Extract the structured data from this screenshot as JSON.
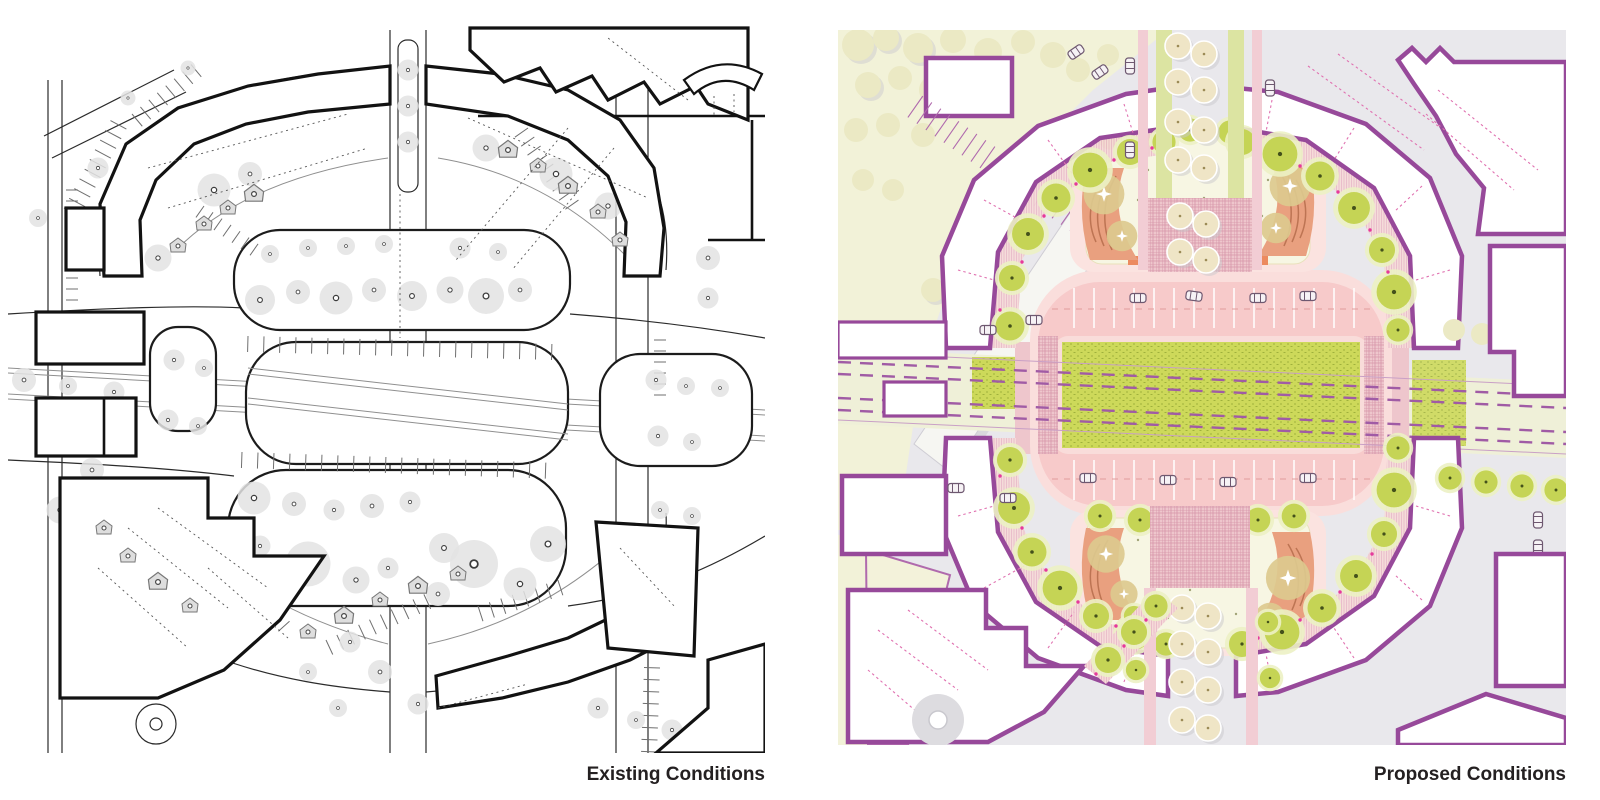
{
  "page": {
    "type": "architectural site plan comparison",
    "background": "#ffffff"
  },
  "panels": [
    {
      "id": "existing",
      "label": "Existing Conditions",
      "style": "monochrome line drawing",
      "palette": {
        "line": "#2b2b2b",
        "building_outline": "#121212",
        "tree_fill": "#e3e3e3",
        "background": "#ffffff"
      }
    },
    {
      "id": "proposed",
      "label": "Proposed Conditions",
      "style": "color rendered plan",
      "palette": {
        "road_gray": "#e9e8ec",
        "building_outline": "#97499a",
        "building_fill": "#ffffff",
        "paving_pink": "#f7caca",
        "sidewalk_pink": "#fadedc",
        "brick_hatch": "#e3a9b8",
        "lawn_green": "#cdd95a",
        "tree_green": "#c5d455",
        "tree_halo": "#e9efbc",
        "tree_tan": "#efe5c6",
        "plaza_cream": "#f7f6e3",
        "terracotta": "#e9a07f",
        "park_pale": "#f2f2d8",
        "tram_purple": "#a05ba5",
        "accent_magenta": "#e6399b"
      }
    }
  ]
}
